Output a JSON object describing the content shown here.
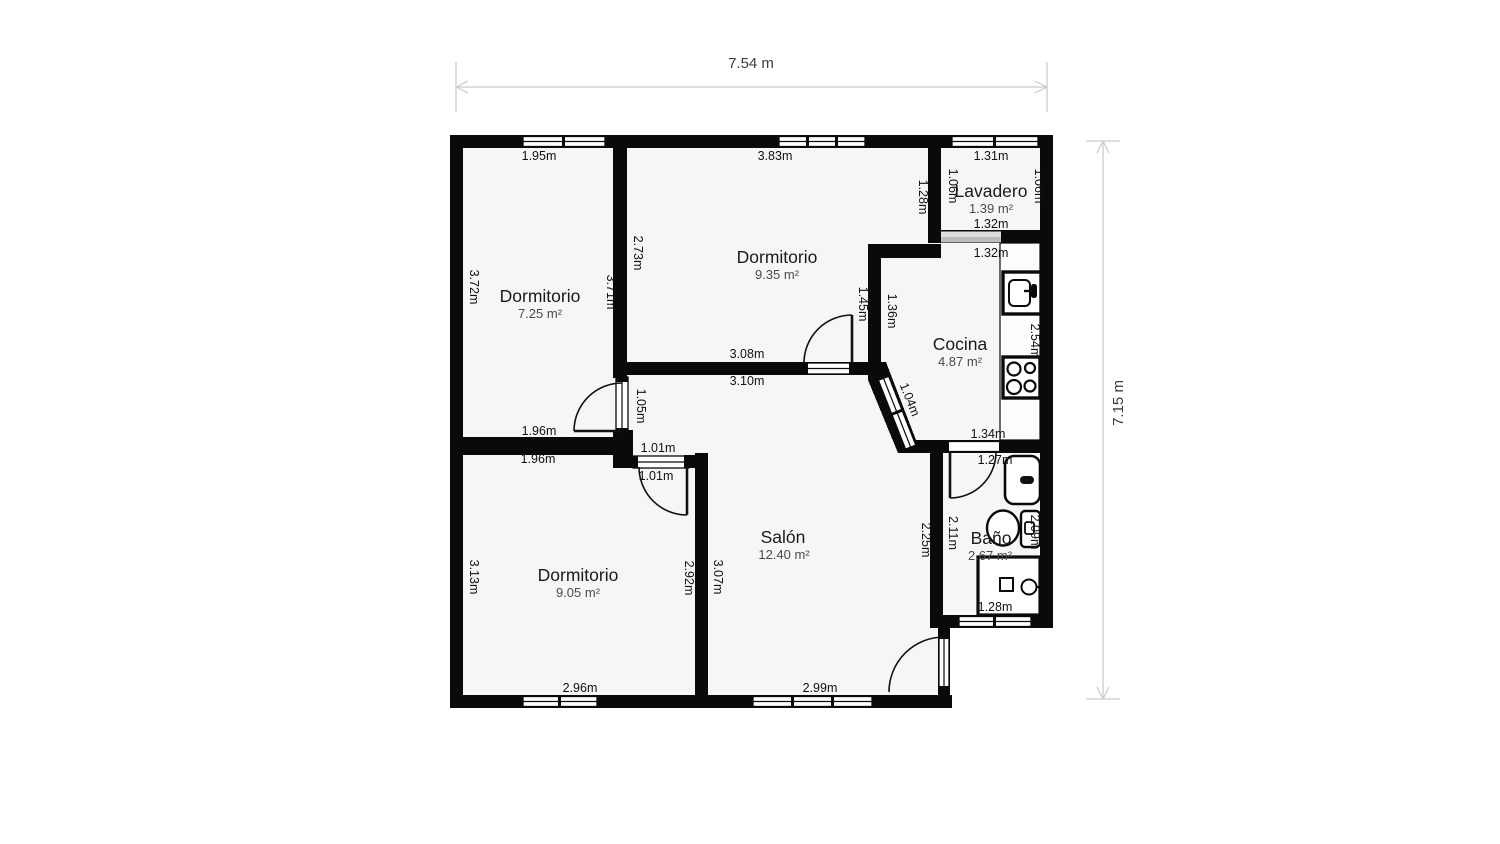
{
  "plan": {
    "overall": {
      "width_label": "7.54 m",
      "height_label": "7.15 m"
    },
    "colors": {
      "wall": "#0a0a0a",
      "room_fill": "#f6f6f6",
      "dimension_line": "#c9c9c9",
      "dimension_text": "#3d3d3d",
      "label_text": "#1a1a1a",
      "area_text": "#4a4a4a"
    },
    "rooms": {
      "dormitorio_1": {
        "name": "Dormitorio",
        "area": "7.25 m²",
        "dims": {
          "top": "1.95m",
          "left": "3.72m",
          "right": "3.71m",
          "bottom": "1.96m",
          "door": "1.05m"
        }
      },
      "dormitorio_2": {
        "name": "Dormitorio",
        "area": "9.35 m²",
        "dims": {
          "top": "3.83m",
          "left": "2.73m",
          "bottom": "3.08m",
          "door": "1.45m",
          "wall_right": "1.36m",
          "wall_right_upper": "1.28m"
        }
      },
      "lavadero": {
        "name": "Lavadero",
        "area": "1.39 m²",
        "dims": {
          "top": "1.31m",
          "left": "1.06m",
          "right": "1.06m",
          "bottom": "1.32m"
        }
      },
      "cocina": {
        "name": "Cocina",
        "area": "4.87 m²",
        "fixtures": [
          "sink",
          "stove"
        ],
        "dims": {
          "top": "1.32m",
          "right": "2.54m",
          "bottom": "1.34m",
          "diag_window": "1.04m"
        }
      },
      "bano": {
        "name": "Baño",
        "area": "2.67 m²",
        "fixtures": [
          "bathtub",
          "toilet",
          "shower"
        ],
        "dims": {
          "top": "1.27m",
          "left": "2.11m",
          "right": "2.09m",
          "bottom": "1.28m"
        }
      },
      "salon": {
        "name": "Salón",
        "area": "12.40 m²",
        "dims": {
          "top": "3.10m",
          "left": "3.07m",
          "right": "2.25m",
          "bottom": "2.99m",
          "diag_window": "1.10m"
        }
      },
      "dormitorio_3": {
        "name": "Dormitorio",
        "area": "9.05 m²",
        "dims": {
          "top": "1.96m",
          "left": "3.13m",
          "right": "2.92m",
          "bottom": "2.96m",
          "door_top": "1.01m",
          "door_bottom": "1.01m"
        }
      }
    }
  }
}
